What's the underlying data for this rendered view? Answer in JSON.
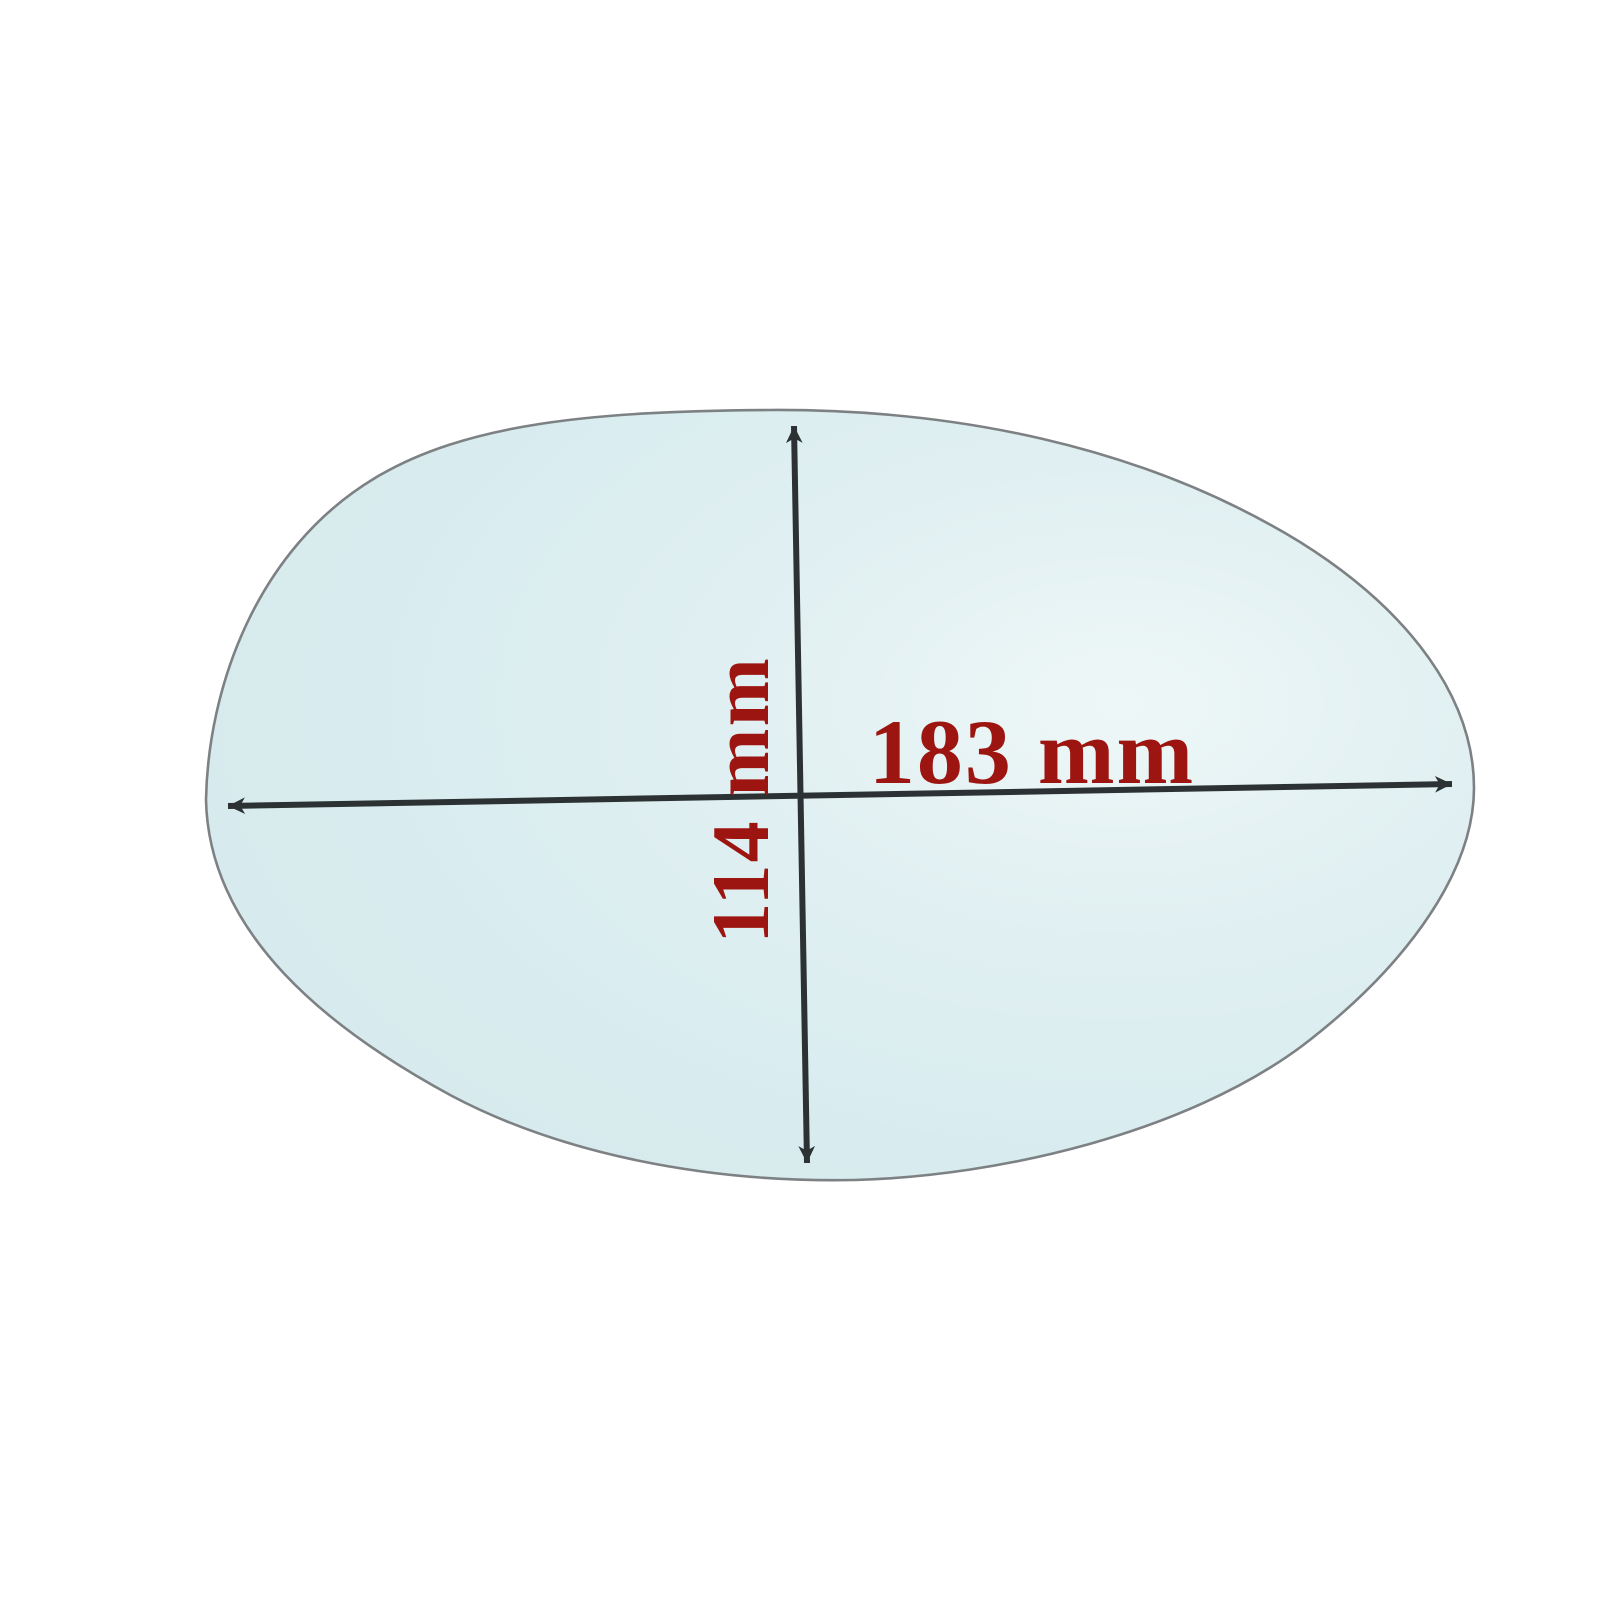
{
  "diagram": {
    "title": "mirror glass dimension diagram",
    "shape": "oval mirror glass",
    "width_dimension": {
      "label": "183 mm",
      "value": 183,
      "unit": "mm",
      "orientation": "horizontal"
    },
    "height_dimension": {
      "label": "114 mm",
      "value": 114,
      "unit": "mm",
      "orientation": "vertical"
    },
    "colors": {
      "background": "#ffffff",
      "glass_fill": "#d8ecef",
      "glass_highlight": "#eef7f7",
      "glass_outline": "#7d8184",
      "dimension_arrow": "#2c3233",
      "dimension_label": "#9d1511"
    }
  }
}
